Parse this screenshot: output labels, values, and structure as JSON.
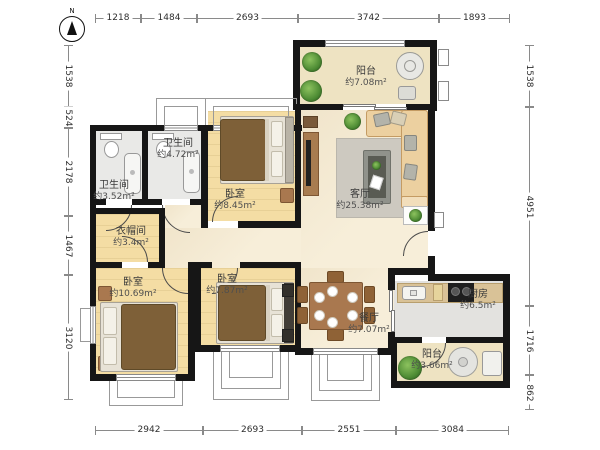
{
  "compass": {
    "label": "N"
  },
  "dimensions": {
    "top": [
      "1218",
      "1484",
      "2693",
      "3742",
      "1893"
    ],
    "bottom": [
      "2942",
      "2693",
      "2551",
      "3084"
    ],
    "left": [
      "1538",
      "524",
      "2178",
      "1467",
      "3120"
    ],
    "right": [
      "1538",
      "4951",
      "1716",
      "862"
    ]
  },
  "rooms": {
    "balcony_top": {
      "name": "阳台",
      "area": "约7.08m²"
    },
    "living_room": {
      "name": "客厅",
      "area": "约25.38m²"
    },
    "bathroom_small": {
      "name": "卫生间",
      "area": "约3.52m²"
    },
    "bathroom_large": {
      "name": "卫生间",
      "area": "约4.72m²"
    },
    "bedroom_top": {
      "name": "卧室",
      "area": "约8.45m²"
    },
    "cloakroom": {
      "name": "衣帽间",
      "area": "约3.4m²"
    },
    "bedroom_left": {
      "name": "卧室",
      "area": "约10.69m²"
    },
    "bedroom_middle": {
      "name": "卧室",
      "area": "约7.87m²"
    },
    "dining_room": {
      "name": "餐厅",
      "area": "约7.07m²"
    },
    "kitchen": {
      "name": "厨房",
      "area": "约6.5m²"
    },
    "balcony_bottom": {
      "name": "阳台",
      "area": "约3.66m²"
    }
  },
  "colors": {
    "wall": "#161616",
    "wood_floor": "#f4dda4",
    "marble_floor": "#f7eed9",
    "balcony_tile": "#eee3c2",
    "bath_tile": "#e9e9e7",
    "kitchen_tile": "#e3e2df",
    "furniture_wood": "#a9784f",
    "blanket_brown": "#7e6038",
    "sofa_beige": "#ecd0a0",
    "plant_green": "#4c8a33"
  }
}
